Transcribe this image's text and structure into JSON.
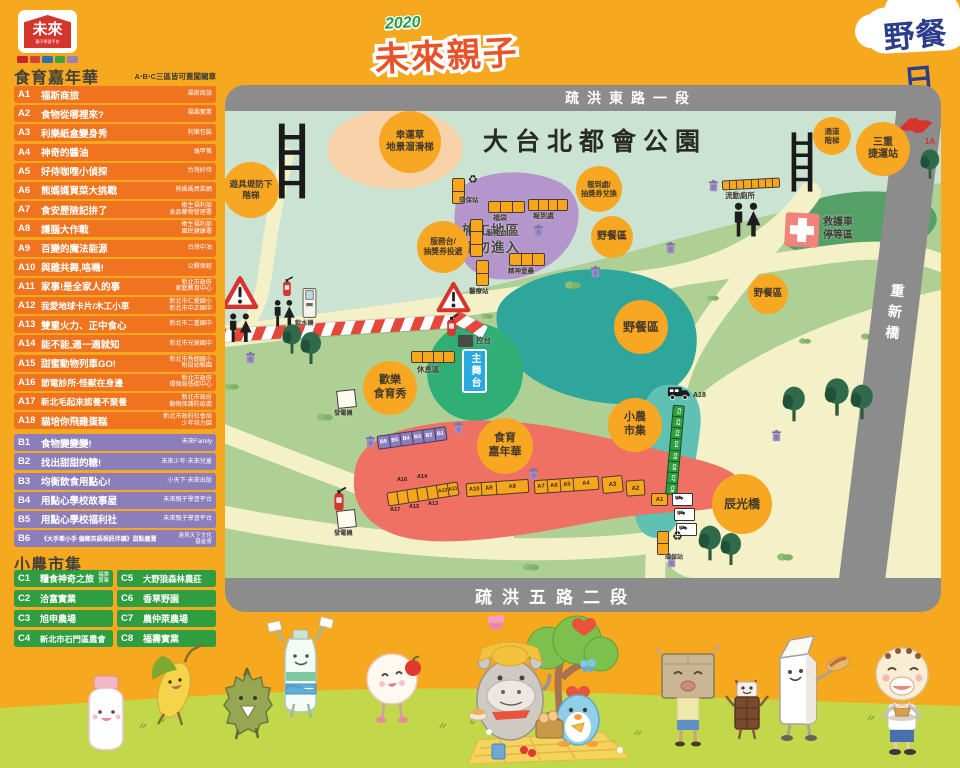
{
  "brand": {
    "name": "未來",
    "subtitle": "親子學習平台",
    "badge_colors": [
      "#C9252C",
      "#D24338",
      "#2B6FB5",
      "#3FA244",
      "#9A7FB8"
    ]
  },
  "title": {
    "year": "2020",
    "main": "未來親子",
    "bubble": "野餐日"
  },
  "legend": {
    "a_header": "食育嘉年華",
    "stamp_note": "A‧B‧C三區皆可蓋闖關章",
    "a_items": [
      {
        "code": "A1",
        "title": "福斯商旅",
        "org": "福斯商旅"
      },
      {
        "code": "A2",
        "title": "食物從哪裡來?",
        "org": "福壽實業"
      },
      {
        "code": "A3",
        "title": "利樂紙盒變身秀",
        "org": "利樂包裝"
      },
      {
        "code": "A4",
        "title": "神奇的醬油",
        "org": "龜甲萬"
      },
      {
        "code": "A5",
        "title": "好侍咖哩小偵探",
        "org": "台灣好侍"
      },
      {
        "code": "A6",
        "title": "熊媽媽買菜大挑戰",
        "org": "熊媽媽買菜網"
      },
      {
        "code": "A7",
        "title": "食安歷險記拚了",
        "org": "衛生福利部\n食品藥物管理署"
      },
      {
        "code": "A8",
        "title": "護腦大作戰",
        "org": "衛生福利部\n國民健康署"
      },
      {
        "code": "A9",
        "title": "百變的魔法能源",
        "org": "台灣中油"
      },
      {
        "code": "A10",
        "title": "與雞共舞,咯嘰!",
        "org": "公勝保經"
      },
      {
        "code": "A11",
        "title": "家事!是全家人的事",
        "org": "新北市政府\n家庭教育中心"
      },
      {
        "code": "A12",
        "title": "我愛地球卡片/木工小車",
        "org": "新北市仁愛國小\n新北市中正國中"
      },
      {
        "code": "A13",
        "title": "雙重火力、正中食心",
        "org": "新北市二重國中"
      },
      {
        "code": "A14",
        "title": "能不能,適一適就知",
        "org": "新北市光榮國中"
      },
      {
        "code": "A15",
        "title": "甜蜜動物列車GO!",
        "org": "新北市秀朗國小\n附設幼稚園"
      },
      {
        "code": "A16",
        "title": "節電診所-怪獸在身邊",
        "org": "新北市政府\n環保局低碳中心"
      },
      {
        "code": "A17",
        "title": "新北毛起來認養不棄養",
        "org": "新北市政府\n動物保護防疫處"
      },
      {
        "code": "A18",
        "title": "貓培你飛雞蛋糕",
        "org": "新北市政府社會局\n少年培力園"
      }
    ],
    "b_items": [
      {
        "code": "B1",
        "title": "食物變變變!",
        "org": "未來Family"
      },
      {
        "code": "B2",
        "title": "找出甜甜的糖!",
        "org": "未來少年‧未來兒童"
      },
      {
        "code": "B3",
        "title": "均衡飲食用點心!",
        "org": "小天下‧未來出版"
      },
      {
        "code": "B4",
        "title": "用點心學校故事屋",
        "org": "未來親子學習平台"
      },
      {
        "code": "B5",
        "title": "用點心學校福利社",
        "org": "未來親子學習平台"
      },
      {
        "code": "B6",
        "title": "《大手牽小手 偏鄉英語視訊伴讀》甜點義賣",
        "org": "遠見天下文化\n基金會"
      }
    ],
    "c_header": "小農市集",
    "c_items": [
      {
        "code": "C1",
        "title": "糧食神奇之旅",
        "org": "福壽\n實業"
      },
      {
        "code": "C2",
        "title": "洽富實業",
        "org": ""
      },
      {
        "code": "C3",
        "title": "旭申農場",
        "org": ""
      },
      {
        "code": "C4",
        "title": "新北市石門區農會",
        "org": ""
      },
      {
        "code": "C5",
        "title": "大野狼森林農莊",
        "org": ""
      },
      {
        "code": "C6",
        "title": "香草野園",
        "org": ""
      },
      {
        "code": "C7",
        "title": "農仲萊農場",
        "org": ""
      },
      {
        "code": "C8",
        "title": "福壽實業",
        "org": ""
      }
    ]
  },
  "map": {
    "park_name": "大台北都會公園",
    "roads": {
      "top": "疏洪東路一段",
      "bottom": "疏洪五路二段",
      "right": "重新橋"
    },
    "metro_code": "1A",
    "circles": {
      "play_stairs": "遊具堤防下\n階梯",
      "clover_slide": "幸運草\n地景溜滑梯",
      "passage_stairs": "通道\n階梯",
      "sanchong_station": "三重\n捷運站",
      "checkin_redeem": "報到處/\n抽獎券兌換",
      "picnic": "野餐區",
      "service_drop": "服務台/\n抽獎券投遞",
      "happy_show": "歡樂\n食育秀",
      "food_carnival": "食育\n嘉年華",
      "farmers_market": "小農\n市集",
      "chenguang_bridge": "辰光橋"
    },
    "labels": {
      "construction": "施工地區\n請勿進入",
      "mobile_toilet": "流動廁所",
      "ambulance": "救護車\n停等區",
      "eco_station": "環保站",
      "lucky_bag": "福袋",
      "checkin": "報到處",
      "service_desk": "服務台",
      "medical": "醫療站",
      "spirit_fort": "精神堡壘",
      "rest_area": "休息區",
      "main_stage": "主舞台",
      "control": "控台",
      "generator": "發電機",
      "water": "飲水機",
      "recycle_glyph": "♻"
    },
    "booths": {
      "left_top": [
        "A16",
        "A14"
      ],
      "left_in": [
        "A12",
        "A11"
      ],
      "left_bottom": [
        "A17",
        "A15",
        "A13"
      ],
      "mid": [
        "A10",
        "A9",
        "A8"
      ],
      "mid2": [
        "A7",
        "A6",
        "A5",
        "A4"
      ],
      "a3": "A3",
      "a2": "A2",
      "a1": "A1",
      "truck": "A18",
      "b": [
        "B6",
        "B5",
        "B4",
        "B3",
        "B2",
        "B1"
      ],
      "c": [
        "C1",
        "C2",
        "C3",
        "C4",
        "C5",
        "C6",
        "C7",
        "C8"
      ]
    }
  },
  "colors": {
    "background": "#F6A81E",
    "row_a": "#F0731F",
    "row_b": "#8C7DBB",
    "row_c": "#2F9E41",
    "map_green": "#AFD094",
    "map_mint": "#CBE3D2",
    "path_yellow": "#F4F1C9",
    "zone_purple": "#B495CC",
    "zone_red": "#EF7164",
    "pond_teal": "#2FA69B",
    "circle_orange": "#F7A722",
    "road_gray": "#8C8C8C",
    "grass": "#C3D74B"
  }
}
